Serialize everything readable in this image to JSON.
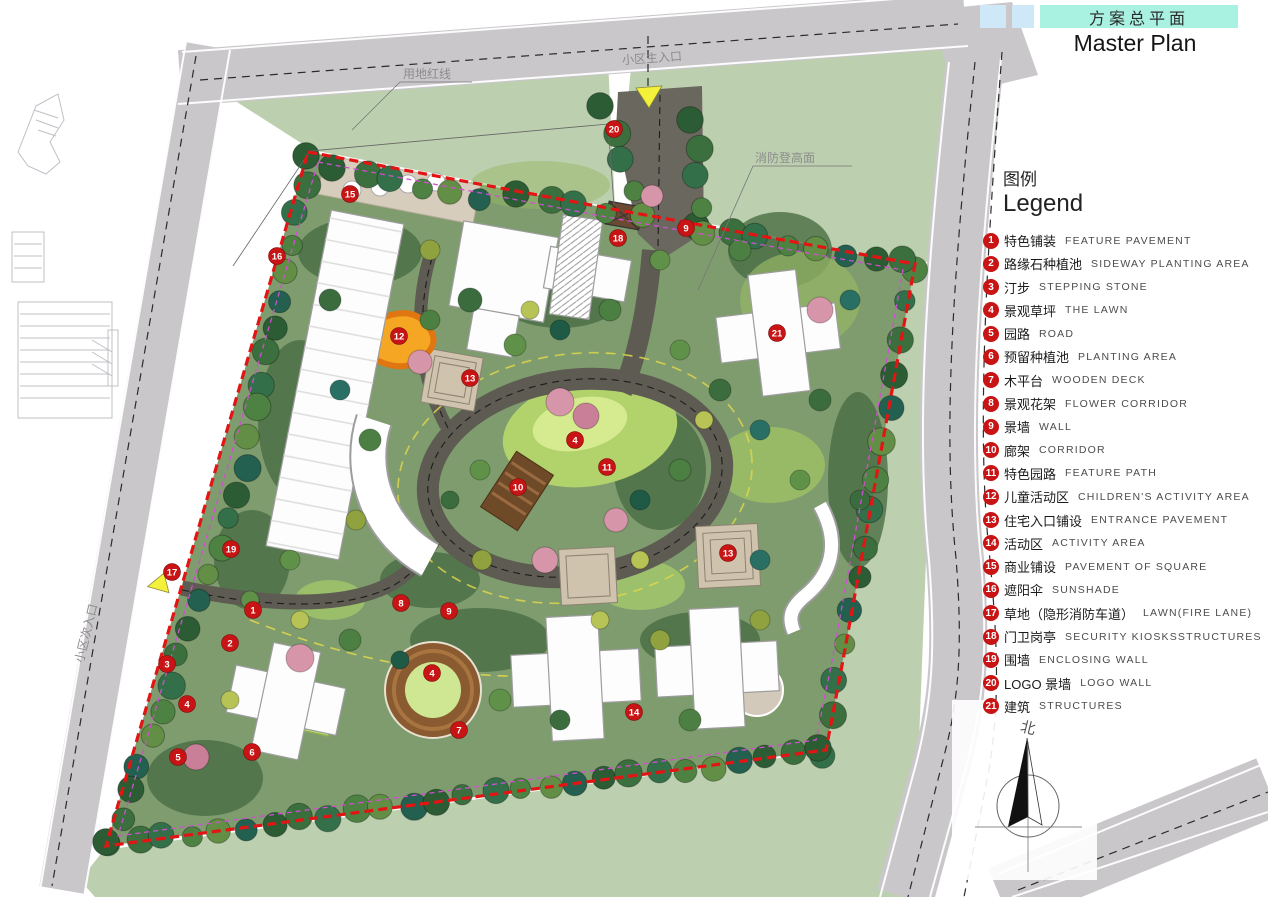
{
  "title": {
    "zh": "方案总平面",
    "en": "Master Plan"
  },
  "legend": {
    "title_zh": "图例",
    "title_en": "Legend",
    "items": [
      {
        "n": "1",
        "zh": "特色铺装",
        "en": "FEATURE PAVEMENT"
      },
      {
        "n": "2",
        "zh": "路缘石种植池",
        "en": "SIDEWAY PLANTING AREA"
      },
      {
        "n": "3",
        "zh": "汀步",
        "en": "STEPPING STONE"
      },
      {
        "n": "4",
        "zh": "景观草坪",
        "en": "THE LAWN"
      },
      {
        "n": "5",
        "zh": "园路",
        "en": "ROAD"
      },
      {
        "n": "6",
        "zh": "预留种植池",
        "en": "PLANTING AREA"
      },
      {
        "n": "7",
        "zh": "木平台",
        "en": "WOODEN DECK"
      },
      {
        "n": "8",
        "zh": "景观花架",
        "en": "FLOWER CORRIDOR"
      },
      {
        "n": "9",
        "zh": "景墙",
        "en": "WALL"
      },
      {
        "n": "10",
        "zh": "廊架",
        "en": "CORRIDOR"
      },
      {
        "n": "11",
        "zh": "特色园路",
        "en": "FEATURE PATH"
      },
      {
        "n": "12",
        "zh": "儿童活动区",
        "en": "CHILDREN'S ACTIVITY AREA"
      },
      {
        "n": "13",
        "zh": "住宅入口铺设",
        "en": "ENTRANCE PAVEMENT"
      },
      {
        "n": "14",
        "zh": "活动区",
        "en": "ACTIVITY AREA"
      },
      {
        "n": "15",
        "zh": "商业铺设",
        "en": "PAVEMENT OF SQUARE"
      },
      {
        "n": "16",
        "zh": "遮阳伞",
        "en": "SUNSHADE"
      },
      {
        "n": "17",
        "zh": "草地（隐形消防车道）",
        "en": "LAWN(FIRE LANE)"
      },
      {
        "n": "18",
        "zh": "门卫岗亭",
        "en": "SECURITY KIOSKSSTRUCTURES"
      },
      {
        "n": "19",
        "zh": "围墙",
        "en": "ENCLOSING WALL"
      },
      {
        "n": "20",
        "zh": "LOGO 景墙",
        "en": "LOGO WALL"
      },
      {
        "n": "21",
        "zh": "建筑",
        "en": "STRUCTURES"
      }
    ]
  },
  "plan": {
    "labels": {
      "red_line": "用地红线",
      "main_entrance": "小区主入口",
      "fire_access": "消防登高面",
      "side_entrance": "小区次入口",
      "north": "北"
    },
    "markers": [
      {
        "n": "20",
        "x": 614,
        "y": 129
      },
      {
        "n": "15",
        "x": 350,
        "y": 194
      },
      {
        "n": "16",
        "x": 277,
        "y": 256
      },
      {
        "n": "18",
        "x": 618,
        "y": 238
      },
      {
        "n": "9",
        "x": 686,
        "y": 228
      },
      {
        "n": "21",
        "x": 777,
        "y": 333
      },
      {
        "n": "12",
        "x": 399,
        "y": 336
      },
      {
        "n": "13",
        "x": 470,
        "y": 378
      },
      {
        "n": "4",
        "x": 575,
        "y": 440
      },
      {
        "n": "11",
        "x": 607,
        "y": 467
      },
      {
        "n": "10",
        "x": 518,
        "y": 487
      },
      {
        "n": "13",
        "x": 728,
        "y": 553
      },
      {
        "n": "19",
        "x": 231,
        "y": 549
      },
      {
        "n": "17",
        "x": 172,
        "y": 572
      },
      {
        "n": "1",
        "x": 253,
        "y": 610
      },
      {
        "n": "2",
        "x": 230,
        "y": 643
      },
      {
        "n": "3",
        "x": 167,
        "y": 664
      },
      {
        "n": "4",
        "x": 187,
        "y": 704
      },
      {
        "n": "5",
        "x": 178,
        "y": 757
      },
      {
        "n": "6",
        "x": 252,
        "y": 752
      },
      {
        "n": "8",
        "x": 401,
        "y": 603
      },
      {
        "n": "9",
        "x": 449,
        "y": 611
      },
      {
        "n": "4",
        "x": 432,
        "y": 673
      },
      {
        "n": "7",
        "x": 459,
        "y": 730
      },
      {
        "n": "14",
        "x": 634,
        "y": 712
      }
    ]
  },
  "colors": {
    "accent_cyan": "#a9f2e1",
    "accent_blue": "#cfe8f8",
    "marker_red": "#c81414",
    "boundary_red": "#e31414",
    "boundary_magenta": "#cf4fd0",
    "road_gray": "#cac7cb",
    "inner_road": "#5d5b52",
    "outer_green": "#bccfae",
    "site_green": "#7f9c6e",
    "lawn_green": "#b2d26c"
  }
}
